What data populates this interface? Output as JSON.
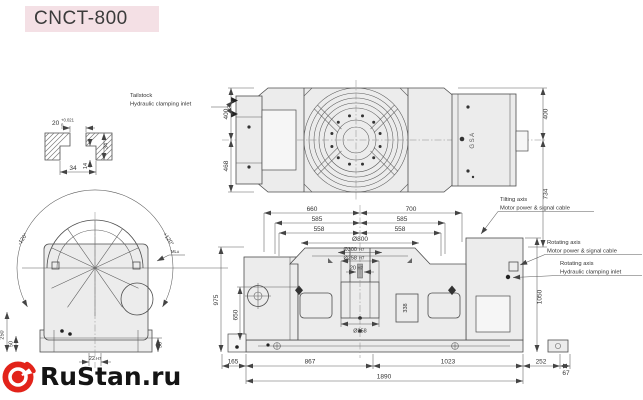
{
  "header": {
    "title": "CNCT-800"
  },
  "watermark": {
    "brand": "RuStan.ru",
    "logo_color": "#e2231a"
  },
  "colors": {
    "title_bg": "#f4e0e5",
    "line": "#4d4d4d",
    "fill": "#ececec",
    "logo_red": "#e2231a"
  },
  "detail_view": {
    "slot_width": "20",
    "tol_upper": "+0.021",
    "tol_lower": "0",
    "depth_total": "34",
    "cavity_height": "14",
    "cavity_width": "34"
  },
  "top_view": {
    "label_tailstock_1": "Tailstock",
    "label_tailstock_2": "Hydraulic clamping inlet",
    "label_tilting_1": "Tilting axis",
    "label_tilting_2": "Motor power & signal cable",
    "dim_left_top": "400",
    "dim_left_bottom": "468",
    "dim_right_top": "400",
    "dim_right_bottom": "734",
    "machine_logo": "GSA"
  },
  "front_view": {
    "dim_660": "660",
    "dim_700": "700",
    "dim_585_left": "585",
    "dim_585_right": "585",
    "dim_558_left": "558",
    "dim_558_right": "558",
    "dim_table_dia": "Ø800",
    "dim_bore1": "Ø300",
    "fit_bore1": "H7",
    "dim_bore2": "Ø258",
    "fit_bore2": "H7",
    "dim_key": "20",
    "fit_key": "H7",
    "dim_spigot": "Ø258",
    "dim_block": "338",
    "dim_165": "165",
    "dim_867": "867",
    "dim_1023": "1023",
    "dim_252": "252",
    "dim_67": "67",
    "dim_1890": "1890",
    "dim_975": "975",
    "dim_650": "650",
    "dim_1050": "1050",
    "label_rot_power_1": "Rotating axis",
    "label_rot_power_2": "Motor power & signal cable",
    "label_rot_hyd_1": "Rotating axis",
    "label_rot_hyd_2": "Hydraulic clamping inlet"
  },
  "side_view": {
    "angle_minus": "-120°",
    "angle_plus": "+120°",
    "dim_22": "22",
    "fit_22": "H7",
    "dim_50_left": "50",
    "dim_50_right": "50",
    "dim_250": "250",
    "note": "ML±"
  }
}
